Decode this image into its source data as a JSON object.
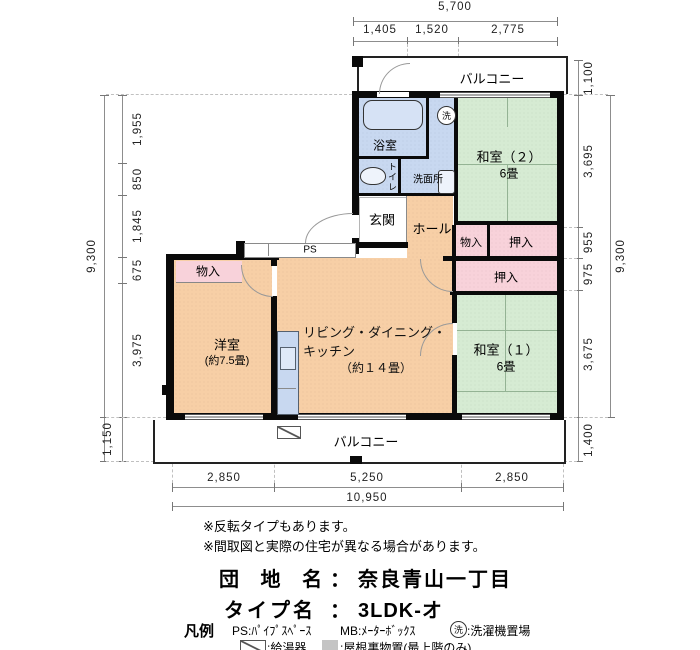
{
  "plan": {
    "balcony_top": "バルコニー",
    "balcony_bottom": "バルコニー",
    "bath": "浴室",
    "washer_symbol": "洗",
    "washroom": "洗面所",
    "toilet": "トイレ",
    "entrance": "玄関",
    "hall": "ホール",
    "ps": "PS",
    "washitsu2_name": "和室（２）",
    "washitsu2_size": "6畳",
    "washitsu1_name": "和室（１）",
    "washitsu1_size": "6畳",
    "closet_hall": "物入",
    "oshiire_upper": "押入",
    "oshiire_lower": "押入",
    "closet_west": "物入",
    "yoshitsu_name": "洋室",
    "yoshitsu_size": "(約7.5畳)",
    "ldk_line1": "リビング・ダイニング・",
    "ldk_line2": "キッチン",
    "ldk_line3": "（約１４畳）"
  },
  "dims": {
    "top_total": "5,700",
    "top_segments": [
      "1,405",
      "1,520",
      "2,775"
    ],
    "left_total": "9,300",
    "left_segments": [
      "1,955",
      "850",
      "1,845",
      "675",
      "3,975"
    ],
    "left_balcony": "1,150",
    "right_balcony_top": "1,100",
    "right_segments": [
      "3,695",
      "955",
      "975",
      "3,675"
    ],
    "right_total": "9,300",
    "right_balcony_bottom": "1,400",
    "bottom_segments": [
      "2,850",
      "5,250",
      "2,850"
    ],
    "bottom_total": "10,950"
  },
  "notes": {
    "note1": "※反転タイプもあります。",
    "note2": "※間取図と実際の住宅が異なる場合があります。"
  },
  "info": {
    "danchi_label": "団 地 名",
    "danchi_colon": "：",
    "danchi_value": "奈良青山一丁目",
    "type_label": "タイプ名",
    "type_colon": "：",
    "type_value": "3LDK-オ"
  },
  "legend": {
    "title": "凡例",
    "ps": "PS:ﾊﾟｲﾌﾟｽﾍﾟｰｽ",
    "mb": "MB:ﾒｰﾀｰﾎﾞｯｸｽ",
    "washer_symbol": "洗",
    "washer_text": ":洗濯機置場",
    "heater_text": ":給湯器",
    "attic_text": ":屋根裏物置(最上階のみ)"
  },
  "icons": {
    "washer": "circled-sen",
    "water_heater": "rect-with-diagonal",
    "attic_storage": "gray-shaded-square"
  },
  "colors": {
    "room_orange": "#f7cfa6",
    "tatami_green": "#d6ebd3",
    "wet_blue": "#c8d8f0",
    "closet_pink": "#f8d2da",
    "wall": "#0a0a0a"
  }
}
